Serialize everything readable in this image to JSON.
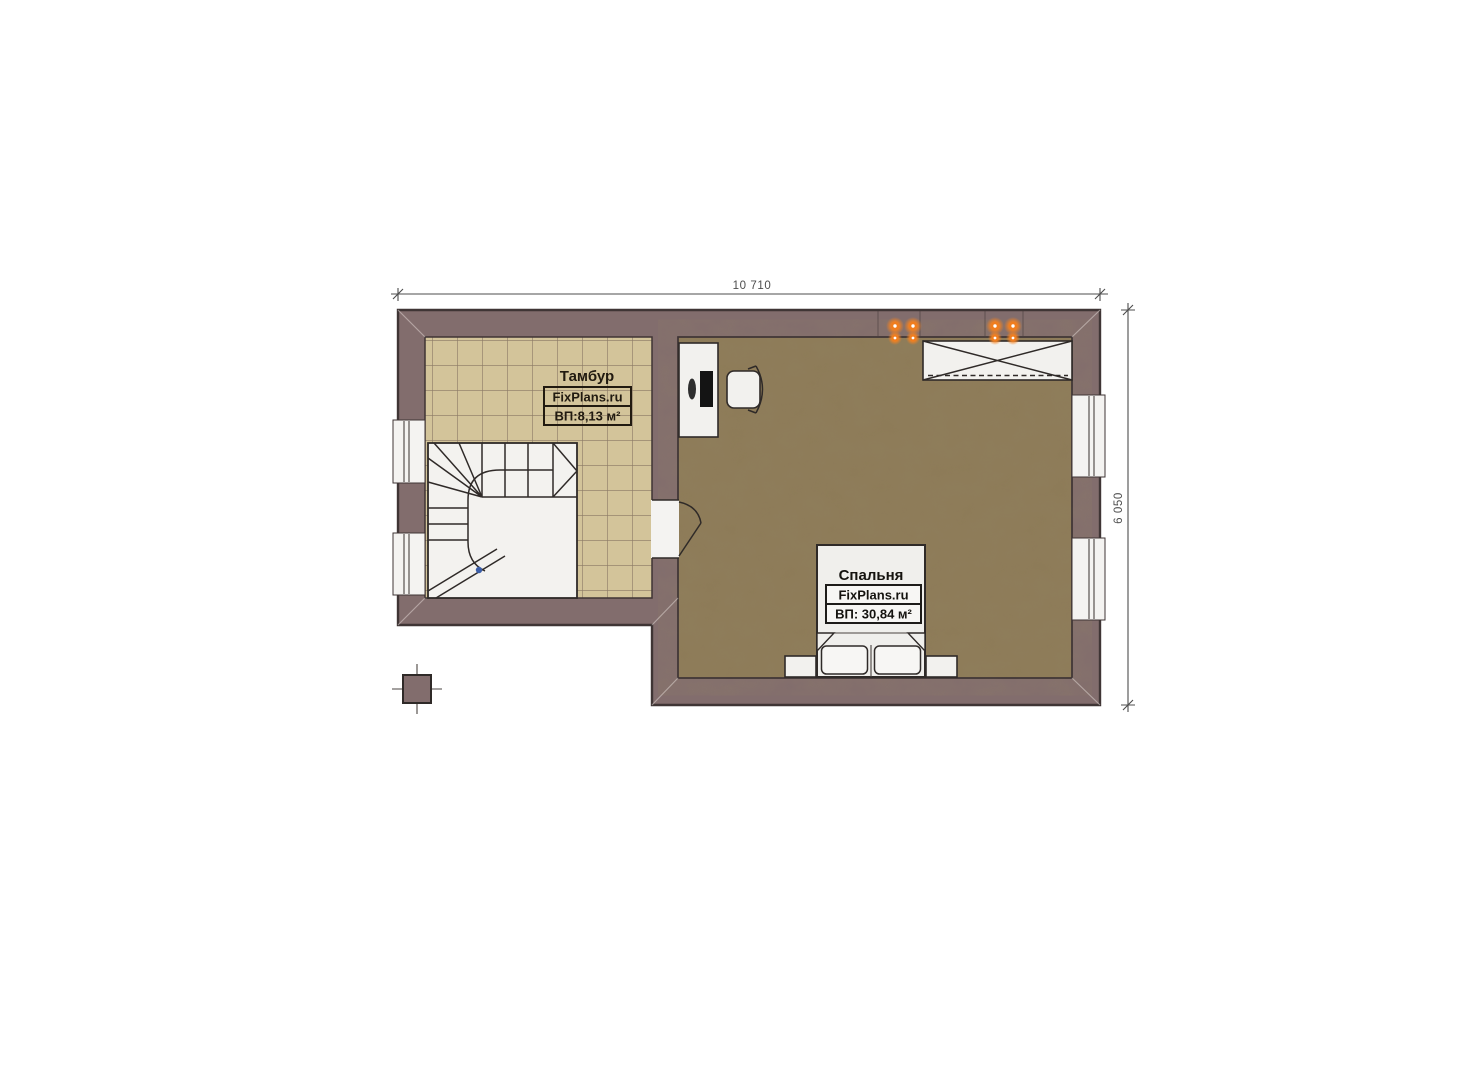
{
  "page": {
    "background": "#ffffff"
  },
  "plan": {
    "dimensions": {
      "width": "10 710",
      "height": "6 050"
    },
    "rooms": {
      "tambour": {
        "name": "Тамбур",
        "brand": "FixPlans.ru",
        "area": "ВП:8,13 м²"
      },
      "bedroom": {
        "name": "Спальня",
        "brand": "FixPlans.ru",
        "area": "ВП: 30,84 м²"
      }
    },
    "colors": {
      "wall": "#826d6d",
      "wall_outline": "#3f3535",
      "tile_floor": "#d3c49a",
      "tile_grout": "#8a7864",
      "wood_floor": "#8d7b58",
      "furniture_fill": "#f2f1ee",
      "furniture_outline": "#2f2a28",
      "sconce_orange": "#f58220",
      "stair_marker_blue": "#3b5ea8",
      "dimension": "#4d4d4d"
    },
    "icons": [
      "stairs-icon",
      "door-swing-icon",
      "window-icon",
      "desk-icon",
      "monitor-icon",
      "office-chair-icon",
      "wardrobe-icon",
      "double-bed-icon",
      "pillow-icon",
      "nightstand-icon",
      "wall-sconce-icon",
      "column-icon"
    ]
  }
}
